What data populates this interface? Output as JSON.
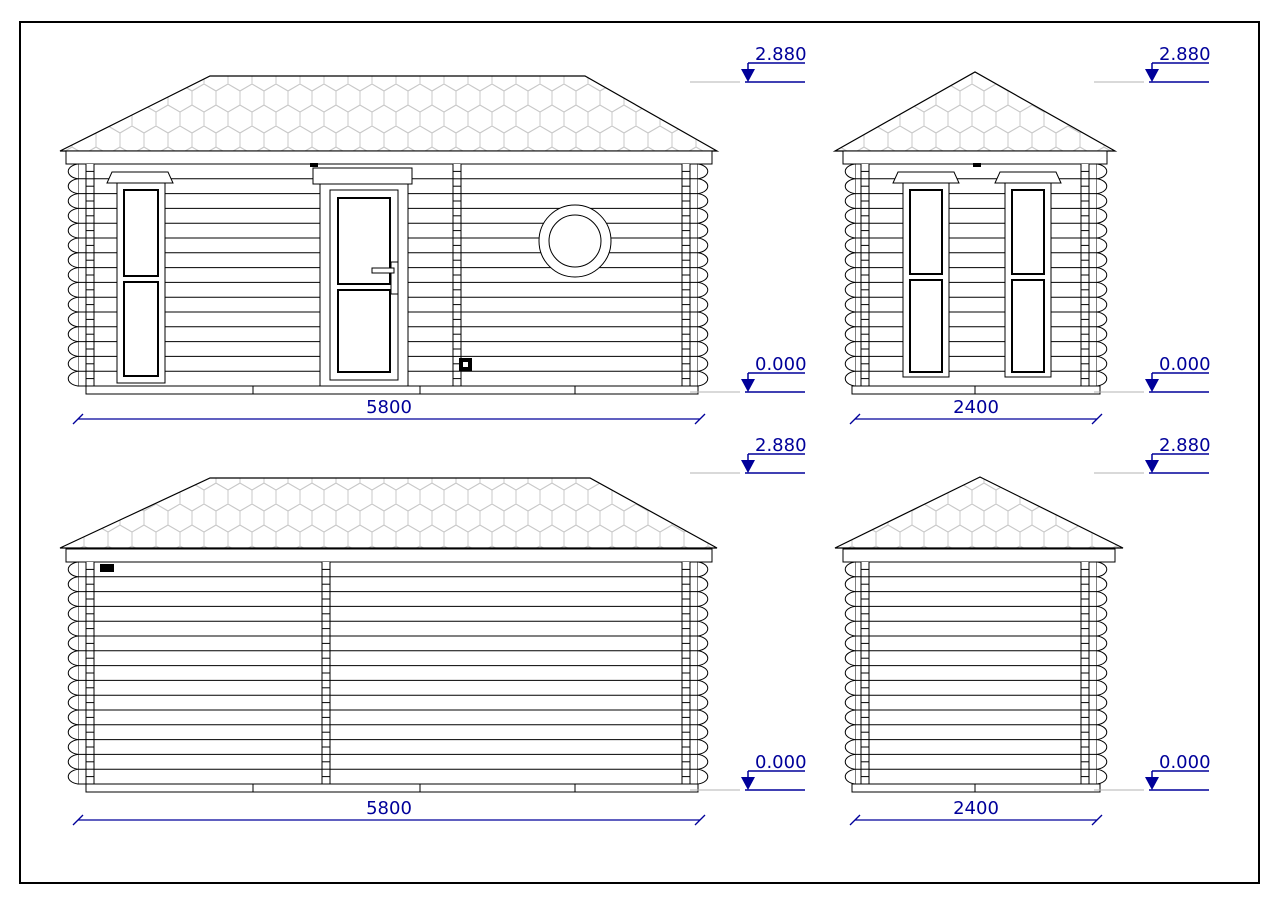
{
  "drawing": {
    "levels": {
      "roof": "2.880",
      "ground": "0.000"
    },
    "dimensions": {
      "long_wall": "5800",
      "short_wall": "2400"
    },
    "colors": {
      "annotation": "#00009a",
      "line": "#000000",
      "shingle": "#c9c9c9",
      "reference": "#b3b3b3"
    }
  }
}
